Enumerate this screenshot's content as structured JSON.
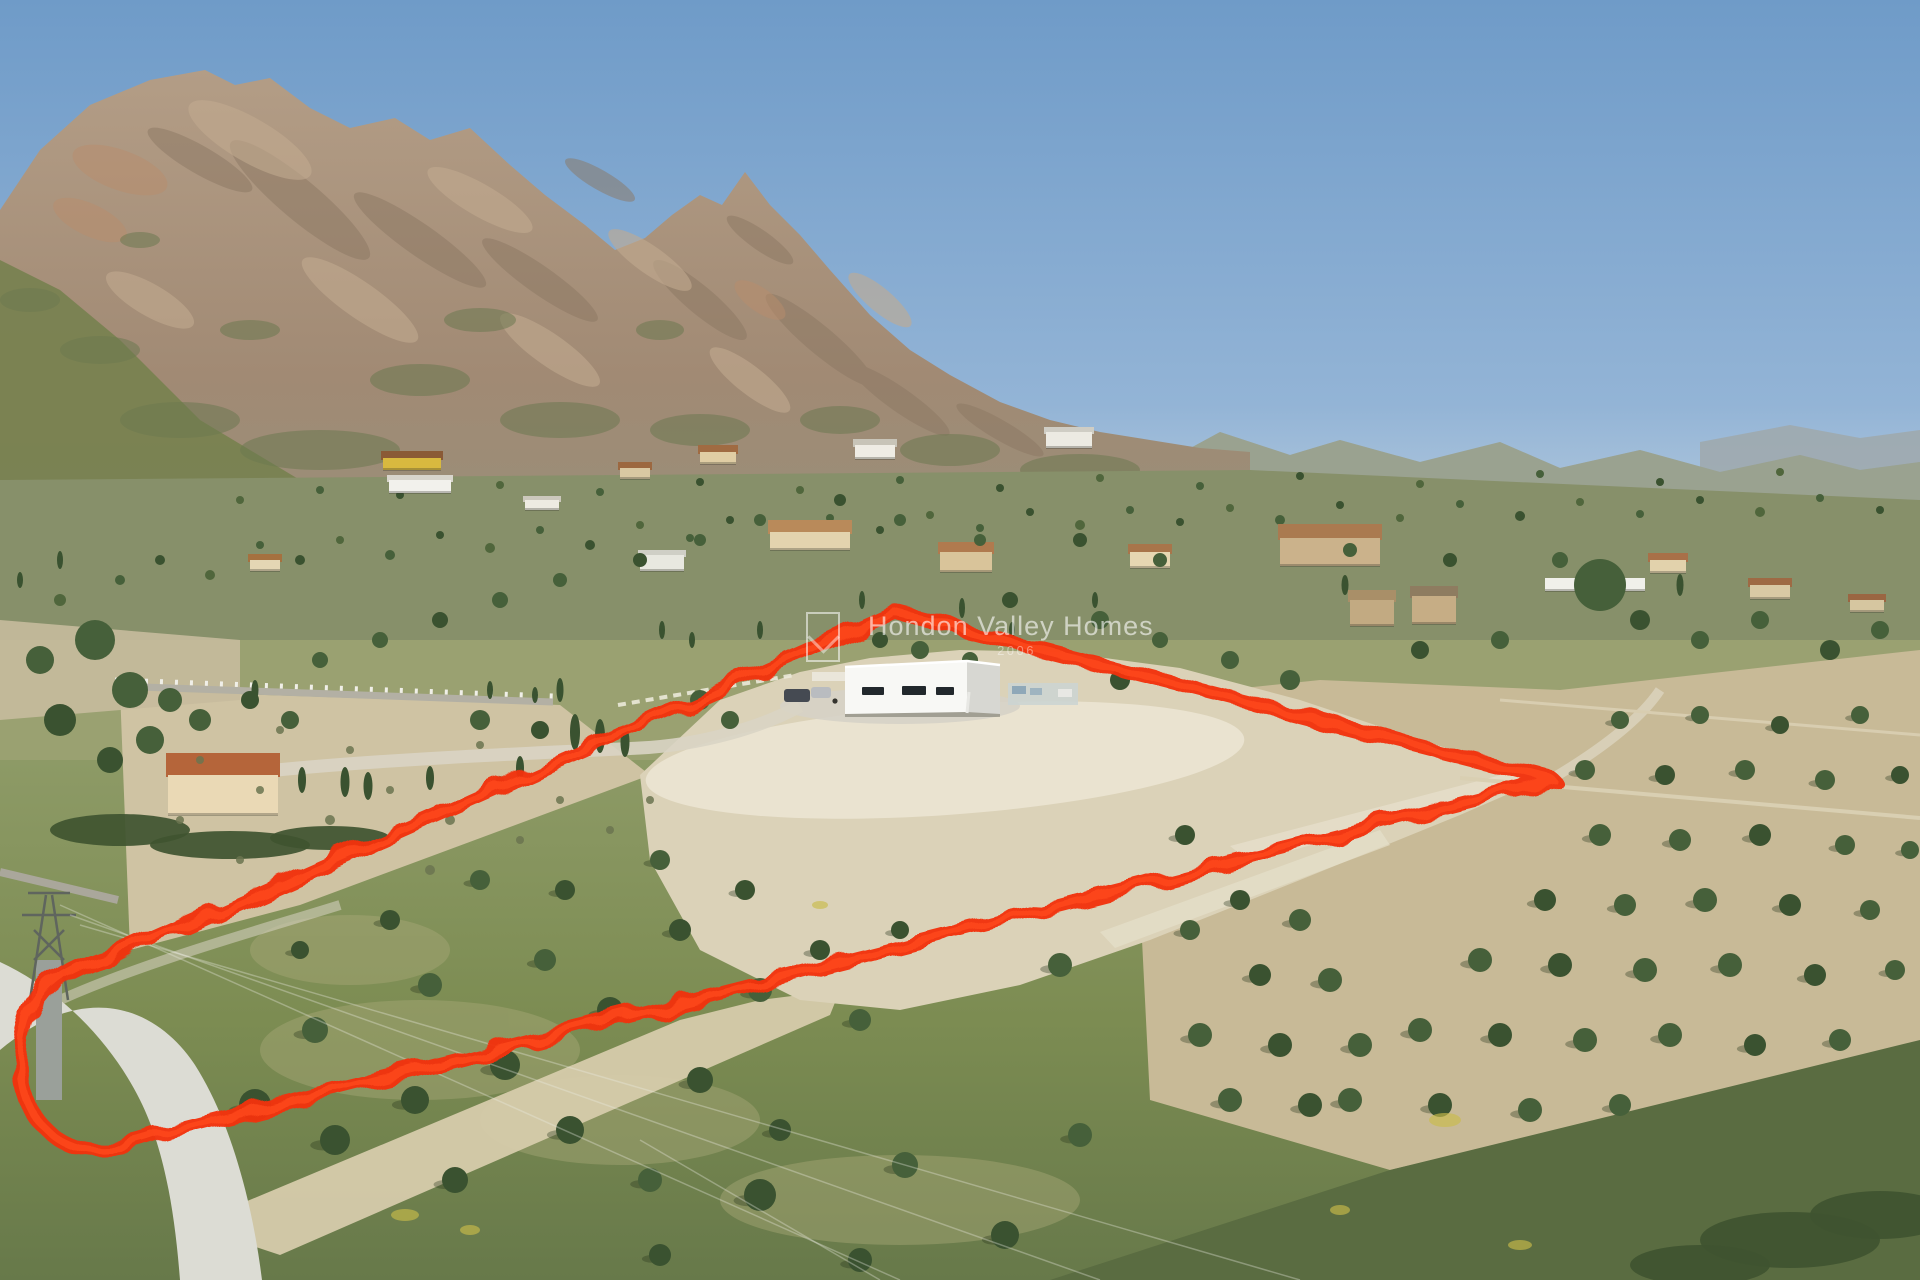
{
  "watermark": {
    "brand": "Hondon Valley Homes",
    "tagline": "2006",
    "logo": "hvh-logo"
  },
  "scene": {
    "colors": {
      "sky_top": "#6f9bc8",
      "sky_low": "#b6cbde",
      "rock": "#ab9580",
      "rock_shadow": "#8a7663",
      "rock_light": "#c2ab90",
      "scrub": "#87906a",
      "mid_base": "#9aa171",
      "field_tan": "#cfc3a3",
      "orchard_tan": "#c8ba97",
      "plot_dirt": "#dbd2b8",
      "sand_light": "#eae3d0",
      "grass_fore": "#7c8c52",
      "grass_dark": "#5a6c41",
      "tree_dark": "#3a5230",
      "tree_mid": "#46603a",
      "tree_far": "#50663c",
      "road": "#dcdcd4",
      "wall_grey": "#b3b0a4",
      "wall_white": "#f0efe8",
      "villa_white": "#f8f8f5",
      "villa_side": "#d7d7d2",
      "window": "#22282c",
      "outline_red": "#f23210",
      "flower_yellow": "#c9bc49"
    },
    "plot_outline": {
      "d": "M 894 612 L 1553 780 L 160 1135 C 60 1172 10 1120 22 1040 C 30 986 70 962 132 950 Z",
      "stroke_width": 15
    },
    "trees_far": [
      [
        60,
        600,
        6
      ],
      [
        120,
        580,
        5
      ],
      [
        160,
        560,
        5
      ],
      [
        210,
        575,
        5
      ],
      [
        260,
        545,
        4
      ],
      [
        300,
        560,
        5
      ],
      [
        340,
        540,
        4
      ],
      [
        390,
        555,
        5
      ],
      [
        440,
        535,
        4
      ],
      [
        490,
        548,
        5
      ],
      [
        540,
        530,
        4
      ],
      [
        590,
        545,
        5
      ],
      [
        640,
        525,
        4
      ],
      [
        690,
        538,
        4
      ],
      [
        730,
        520,
        4
      ],
      [
        780,
        535,
        5
      ],
      [
        830,
        518,
        4
      ],
      [
        880,
        530,
        4
      ],
      [
        930,
        515,
        4
      ],
      [
        980,
        528,
        4
      ],
      [
        1030,
        512,
        4
      ],
      [
        1080,
        525,
        5
      ],
      [
        1130,
        510,
        4
      ],
      [
        1180,
        522,
        4
      ],
      [
        1230,
        508,
        4
      ],
      [
        1280,
        520,
        5
      ],
      [
        1340,
        505,
        4
      ],
      [
        1400,
        518,
        4
      ],
      [
        1460,
        504,
        4
      ],
      [
        1520,
        516,
        5
      ],
      [
        1580,
        502,
        4
      ],
      [
        1640,
        514,
        4
      ],
      [
        1700,
        500,
        4
      ],
      [
        1760,
        512,
        5
      ],
      [
        1820,
        498,
        4
      ],
      [
        1880,
        510,
        4
      ],
      [
        240,
        500,
        4
      ],
      [
        320,
        490,
        4
      ],
      [
        400,
        495,
        4
      ],
      [
        500,
        485,
        4
      ],
      [
        600,
        492,
        4
      ],
      [
        700,
        482,
        4
      ],
      [
        800,
        490,
        4
      ],
      [
        900,
        480,
        4
      ],
      [
        1000,
        488,
        4
      ],
      [
        1100,
        478,
        4
      ],
      [
        1200,
        486,
        4
      ],
      [
        1300,
        476,
        4
      ],
      [
        1420,
        484,
        4
      ],
      [
        1540,
        474,
        4
      ],
      [
        1660,
        482,
        4
      ],
      [
        1780,
        472,
        4
      ]
    ],
    "trees_mid": [
      [
        95,
        640,
        20
      ],
      [
        130,
        690,
        18
      ],
      [
        60,
        720,
        16
      ],
      [
        150,
        740,
        14
      ],
      [
        40,
        660,
        14
      ],
      [
        110,
        760,
        13
      ],
      [
        170,
        700,
        12
      ],
      [
        200,
        720,
        11
      ],
      [
        250,
        700,
        9
      ],
      [
        290,
        720,
        9
      ],
      [
        480,
        720,
        10
      ],
      [
        540,
        730,
        9
      ],
      [
        700,
        700,
        10
      ],
      [
        730,
        720,
        9
      ],
      [
        880,
        640,
        8
      ],
      [
        920,
        650,
        9
      ],
      [
        970,
        660,
        8
      ],
      [
        1010,
        600,
        8
      ],
      [
        1100,
        620,
        9
      ],
      [
        1160,
        640,
        8
      ],
      [
        1120,
        680,
        10
      ],
      [
        1230,
        660,
        9
      ],
      [
        1290,
        680,
        10
      ],
      [
        1420,
        650,
        9
      ],
      [
        1500,
        640,
        9
      ],
      [
        1600,
        585,
        26
      ],
      [
        1640,
        620,
        10
      ],
      [
        1700,
        640,
        9
      ],
      [
        1760,
        620,
        9
      ],
      [
        1830,
        650,
        10
      ],
      [
        1880,
        630,
        9
      ],
      [
        1560,
        560,
        8
      ],
      [
        1450,
        560,
        7
      ],
      [
        1350,
        550,
        7
      ],
      [
        1160,
        560,
        7
      ],
      [
        1080,
        540,
        7
      ],
      [
        980,
        540,
        6
      ],
      [
        900,
        520,
        6
      ],
      [
        840,
        500,
        6
      ],
      [
        760,
        520,
        6
      ],
      [
        700,
        540,
        6
      ],
      [
        640,
        560,
        7
      ],
      [
        560,
        580,
        7
      ],
      [
        500,
        600,
        8
      ],
      [
        440,
        620,
        8
      ],
      [
        380,
        640,
        8
      ],
      [
        320,
        660,
        8
      ]
    ],
    "trees_field": [
      [
        255,
        1105,
        16
      ],
      [
        315,
        1030,
        13
      ],
      [
        335,
        1140,
        15
      ],
      [
        415,
        1100,
        14
      ],
      [
        430,
        985,
        12
      ],
      [
        455,
        1180,
        13
      ],
      [
        505,
        1065,
        15
      ],
      [
        545,
        960,
        11
      ],
      [
        570,
        1130,
        14
      ],
      [
        610,
        1010,
        13
      ],
      [
        650,
        1180,
        12
      ],
      [
        680,
        930,
        11
      ],
      [
        700,
        1080,
        13
      ],
      [
        760,
        990,
        12
      ],
      [
        780,
        1130,
        11
      ],
      [
        565,
        890,
        10
      ],
      [
        480,
        880,
        10
      ],
      [
        390,
        920,
        10
      ],
      [
        300,
        950,
        9
      ],
      [
        660,
        860,
        10
      ],
      [
        745,
        890,
        10
      ],
      [
        820,
        950,
        10
      ],
      [
        860,
        1020,
        11
      ],
      [
        900,
        930,
        9
      ],
      [
        760,
        1195,
        16
      ],
      [
        905,
        1165,
        13
      ],
      [
        1005,
        1235,
        14
      ],
      [
        860,
        1260,
        12
      ],
      [
        1080,
        1135,
        12
      ],
      [
        660,
        1255,
        11
      ],
      [
        1185,
        835,
        10
      ],
      [
        1060,
        965,
        12
      ]
    ],
    "trees_orchard": [
      [
        1620,
        720,
        9
      ],
      [
        1700,
        715,
        9
      ],
      [
        1780,
        725,
        9
      ],
      [
        1860,
        715,
        9
      ],
      [
        1585,
        770,
        10
      ],
      [
        1665,
        775,
        10
      ],
      [
        1745,
        770,
        10
      ],
      [
        1825,
        780,
        10
      ],
      [
        1900,
        775,
        9
      ],
      [
        1600,
        835,
        11
      ],
      [
        1680,
        840,
        11
      ],
      [
        1760,
        835,
        11
      ],
      [
        1845,
        845,
        10
      ],
      [
        1910,
        850,
        9
      ],
      [
        1545,
        900,
        11
      ],
      [
        1625,
        905,
        11
      ],
      [
        1705,
        900,
        12
      ],
      [
        1790,
        905,
        11
      ],
      [
        1870,
        910,
        10
      ],
      [
        1480,
        960,
        12
      ],
      [
        1560,
        965,
        12
      ],
      [
        1645,
        970,
        12
      ],
      [
        1730,
        965,
        12
      ],
      [
        1815,
        975,
        11
      ],
      [
        1895,
        970,
        10
      ],
      [
        1420,
        1030,
        12
      ],
      [
        1500,
        1035,
        12
      ],
      [
        1585,
        1040,
        12
      ],
      [
        1670,
        1035,
        12
      ],
      [
        1755,
        1045,
        11
      ],
      [
        1840,
        1040,
        11
      ],
      [
        1350,
        1100,
        12
      ],
      [
        1440,
        1105,
        12
      ],
      [
        1530,
        1110,
        12
      ],
      [
        1620,
        1105,
        11
      ],
      [
        1240,
        900,
        10
      ],
      [
        1300,
        920,
        11
      ],
      [
        1190,
        930,
        10
      ],
      [
        1260,
        975,
        11
      ],
      [
        1330,
        980,
        12
      ],
      [
        1200,
        1035,
        12
      ],
      [
        1280,
        1045,
        12
      ],
      [
        1360,
        1045,
        12
      ],
      [
        1230,
        1100,
        12
      ],
      [
        1310,
        1105,
        12
      ]
    ],
    "cypresses": [
      [
        345,
        782,
        9,
        30
      ],
      [
        368,
        786,
        9,
        28
      ],
      [
        302,
        780,
        8,
        26
      ],
      [
        430,
        778,
        8,
        24
      ],
      [
        520,
        768,
        8,
        24
      ],
      [
        575,
        732,
        10,
        36
      ],
      [
        600,
        736,
        10,
        34
      ],
      [
        625,
        742,
        9,
        30
      ],
      [
        560,
        690,
        7,
        24
      ],
      [
        662,
        630,
        6,
        18
      ],
      [
        692,
        640,
        6,
        16
      ],
      [
        760,
        630,
        6,
        18
      ],
      [
        862,
        600,
        6,
        18
      ],
      [
        962,
        608,
        6,
        20
      ],
      [
        1012,
        630,
        6,
        16
      ],
      [
        255,
        690,
        7,
        20
      ],
      [
        60,
        560,
        6,
        18
      ],
      [
        20,
        580,
        6,
        16
      ],
      [
        1095,
        600,
        6,
        16
      ],
      [
        1345,
        585,
        7,
        20
      ],
      [
        1680,
        585,
        7,
        22
      ],
      [
        490,
        690,
        6,
        18
      ],
      [
        535,
        695,
        6,
        16
      ]
    ],
    "shrubs": [
      [
        200,
        760,
        4
      ],
      [
        260,
        790,
        4
      ],
      [
        330,
        820,
        5
      ],
      [
        390,
        790,
        4
      ],
      [
        450,
        820,
        5
      ],
      [
        500,
        780,
        4
      ],
      [
        240,
        860,
        4
      ],
      [
        300,
        880,
        5
      ],
      [
        360,
        850,
        4
      ],
      [
        430,
        870,
        5
      ],
      [
        180,
        820,
        4
      ],
      [
        520,
        840,
        4
      ],
      [
        560,
        800,
        4
      ],
      [
        480,
        745,
        4
      ],
      [
        280,
        730,
        4
      ],
      [
        350,
        750,
        4
      ],
      [
        610,
        830,
        4
      ],
      [
        650,
        800,
        4
      ]
    ],
    "hedges": [
      [
        120,
        830,
        70,
        16
      ],
      [
        230,
        845,
        80,
        14
      ],
      [
        330,
        838,
        60,
        12
      ],
      [
        1790,
        1240,
        90,
        28
      ],
      [
        1880,
        1215,
        70,
        24
      ],
      [
        1700,
        1265,
        70,
        20
      ]
    ],
    "houses": [
      {
        "x": 168,
        "y": 775,
        "w": 110,
        "h": 40,
        "rh": 22,
        "wall": "#ead9b5",
        "roof": "#b5653a"
      },
      {
        "x": 383,
        "y": 458,
        "w": 58,
        "h": 12,
        "rh": 7,
        "wall": "#d8b93f",
        "roof": "#8a5a36"
      },
      {
        "x": 389,
        "y": 480,
        "w": 62,
        "h": 13,
        "rh": 5,
        "wall": "#f2f1ec",
        "roof": "#d8d5cc"
      },
      {
        "x": 770,
        "y": 532,
        "w": 80,
        "h": 18,
        "rh": 12,
        "wall": "#e3d3ae",
        "roof": "#b98a5a"
      },
      {
        "x": 940,
        "y": 552,
        "w": 52,
        "h": 20,
        "rh": 10,
        "wall": "#d9c49a",
        "roof": "#b07a4e"
      },
      {
        "x": 1046,
        "y": 432,
        "w": 46,
        "h": 16,
        "rh": 5,
        "wall": "#eceae2",
        "roof": "#cfcdc4"
      },
      {
        "x": 855,
        "y": 445,
        "w": 40,
        "h": 14,
        "rh": 6,
        "wall": "#efece4",
        "roof": "#c8c4b8"
      },
      {
        "x": 700,
        "y": 452,
        "w": 36,
        "h": 12,
        "rh": 7,
        "wall": "#e0cda4",
        "roof": "#a06b42"
      },
      {
        "x": 620,
        "y": 468,
        "w": 30,
        "h": 11,
        "rh": 6,
        "wall": "#d9c8a2",
        "roof": "#9c6840"
      },
      {
        "x": 1280,
        "y": 538,
        "w": 100,
        "h": 28,
        "rh": 14,
        "wall": "#cbb28b",
        "roof": "#aa7a50"
      },
      {
        "x": 1350,
        "y": 600,
        "w": 44,
        "h": 26,
        "rh": 10,
        "wall": "#c2aa82",
        "roof": "#a98f68"
      },
      {
        "x": 1412,
        "y": 596,
        "w": 44,
        "h": 28,
        "rh": 10,
        "wall": "#c6ad85",
        "roof": "#8e7c60"
      },
      {
        "x": 1545,
        "y": 578,
        "w": 100,
        "h": 13,
        "rh": 0,
        "wall": "#f0f0ea",
        "roof": "#f0f0ea"
      },
      {
        "x": 1130,
        "y": 552,
        "w": 40,
        "h": 16,
        "rh": 8,
        "wall": "#e6d7b2",
        "roof": "#a8754a"
      },
      {
        "x": 1650,
        "y": 560,
        "w": 36,
        "h": 13,
        "rh": 7,
        "wall": "#e2d2ac",
        "roof": "#a87048"
      },
      {
        "x": 1750,
        "y": 585,
        "w": 40,
        "h": 14,
        "rh": 7,
        "wall": "#d9c9a4",
        "roof": "#9e6a44"
      },
      {
        "x": 525,
        "y": 500,
        "w": 34,
        "h": 10,
        "rh": 4,
        "wall": "#eeebe2",
        "roof": "#ccc8bc"
      },
      {
        "x": 250,
        "y": 560,
        "w": 30,
        "h": 11,
        "rh": 6,
        "wall": "#e4d6b4",
        "roof": "#a5713f"
      },
      {
        "x": 640,
        "y": 555,
        "w": 44,
        "h": 16,
        "rh": 5,
        "wall": "#e8e8e0",
        "roof": "#cfcfc6"
      },
      {
        "x": 1850,
        "y": 600,
        "w": 34,
        "h": 12,
        "rh": 6,
        "wall": "#d6c6a0",
        "roof": "#9a6642"
      }
    ],
    "walls": [
      [
        115,
        686,
        553,
        702,
        7,
        "#b3b0a4"
      ],
      [
        0,
        872,
        118,
        900,
        8,
        "#aaa79b"
      ],
      [
        1460,
        778,
        1920,
        818,
        4,
        "#d9cfb2"
      ],
      [
        1500,
        700,
        1920,
        735,
        3,
        "#d8cdb0"
      ]
    ],
    "flowers": [
      [
        405,
        1215,
        14,
        6
      ],
      [
        1445,
        1120,
        16,
        7
      ],
      [
        1520,
        1245,
        12,
        5
      ],
      [
        470,
        1230,
        10,
        5
      ],
      [
        820,
        905,
        8,
        4
      ],
      [
        1340,
        1210,
        10,
        5
      ]
    ],
    "wires": [
      [
        60,
        905,
        900,
        1280
      ],
      [
        70,
        915,
        1100,
        1280
      ],
      [
        80,
        925,
        1300,
        1280
      ],
      [
        640,
        1140,
        880,
        1280
      ]
    ]
  }
}
